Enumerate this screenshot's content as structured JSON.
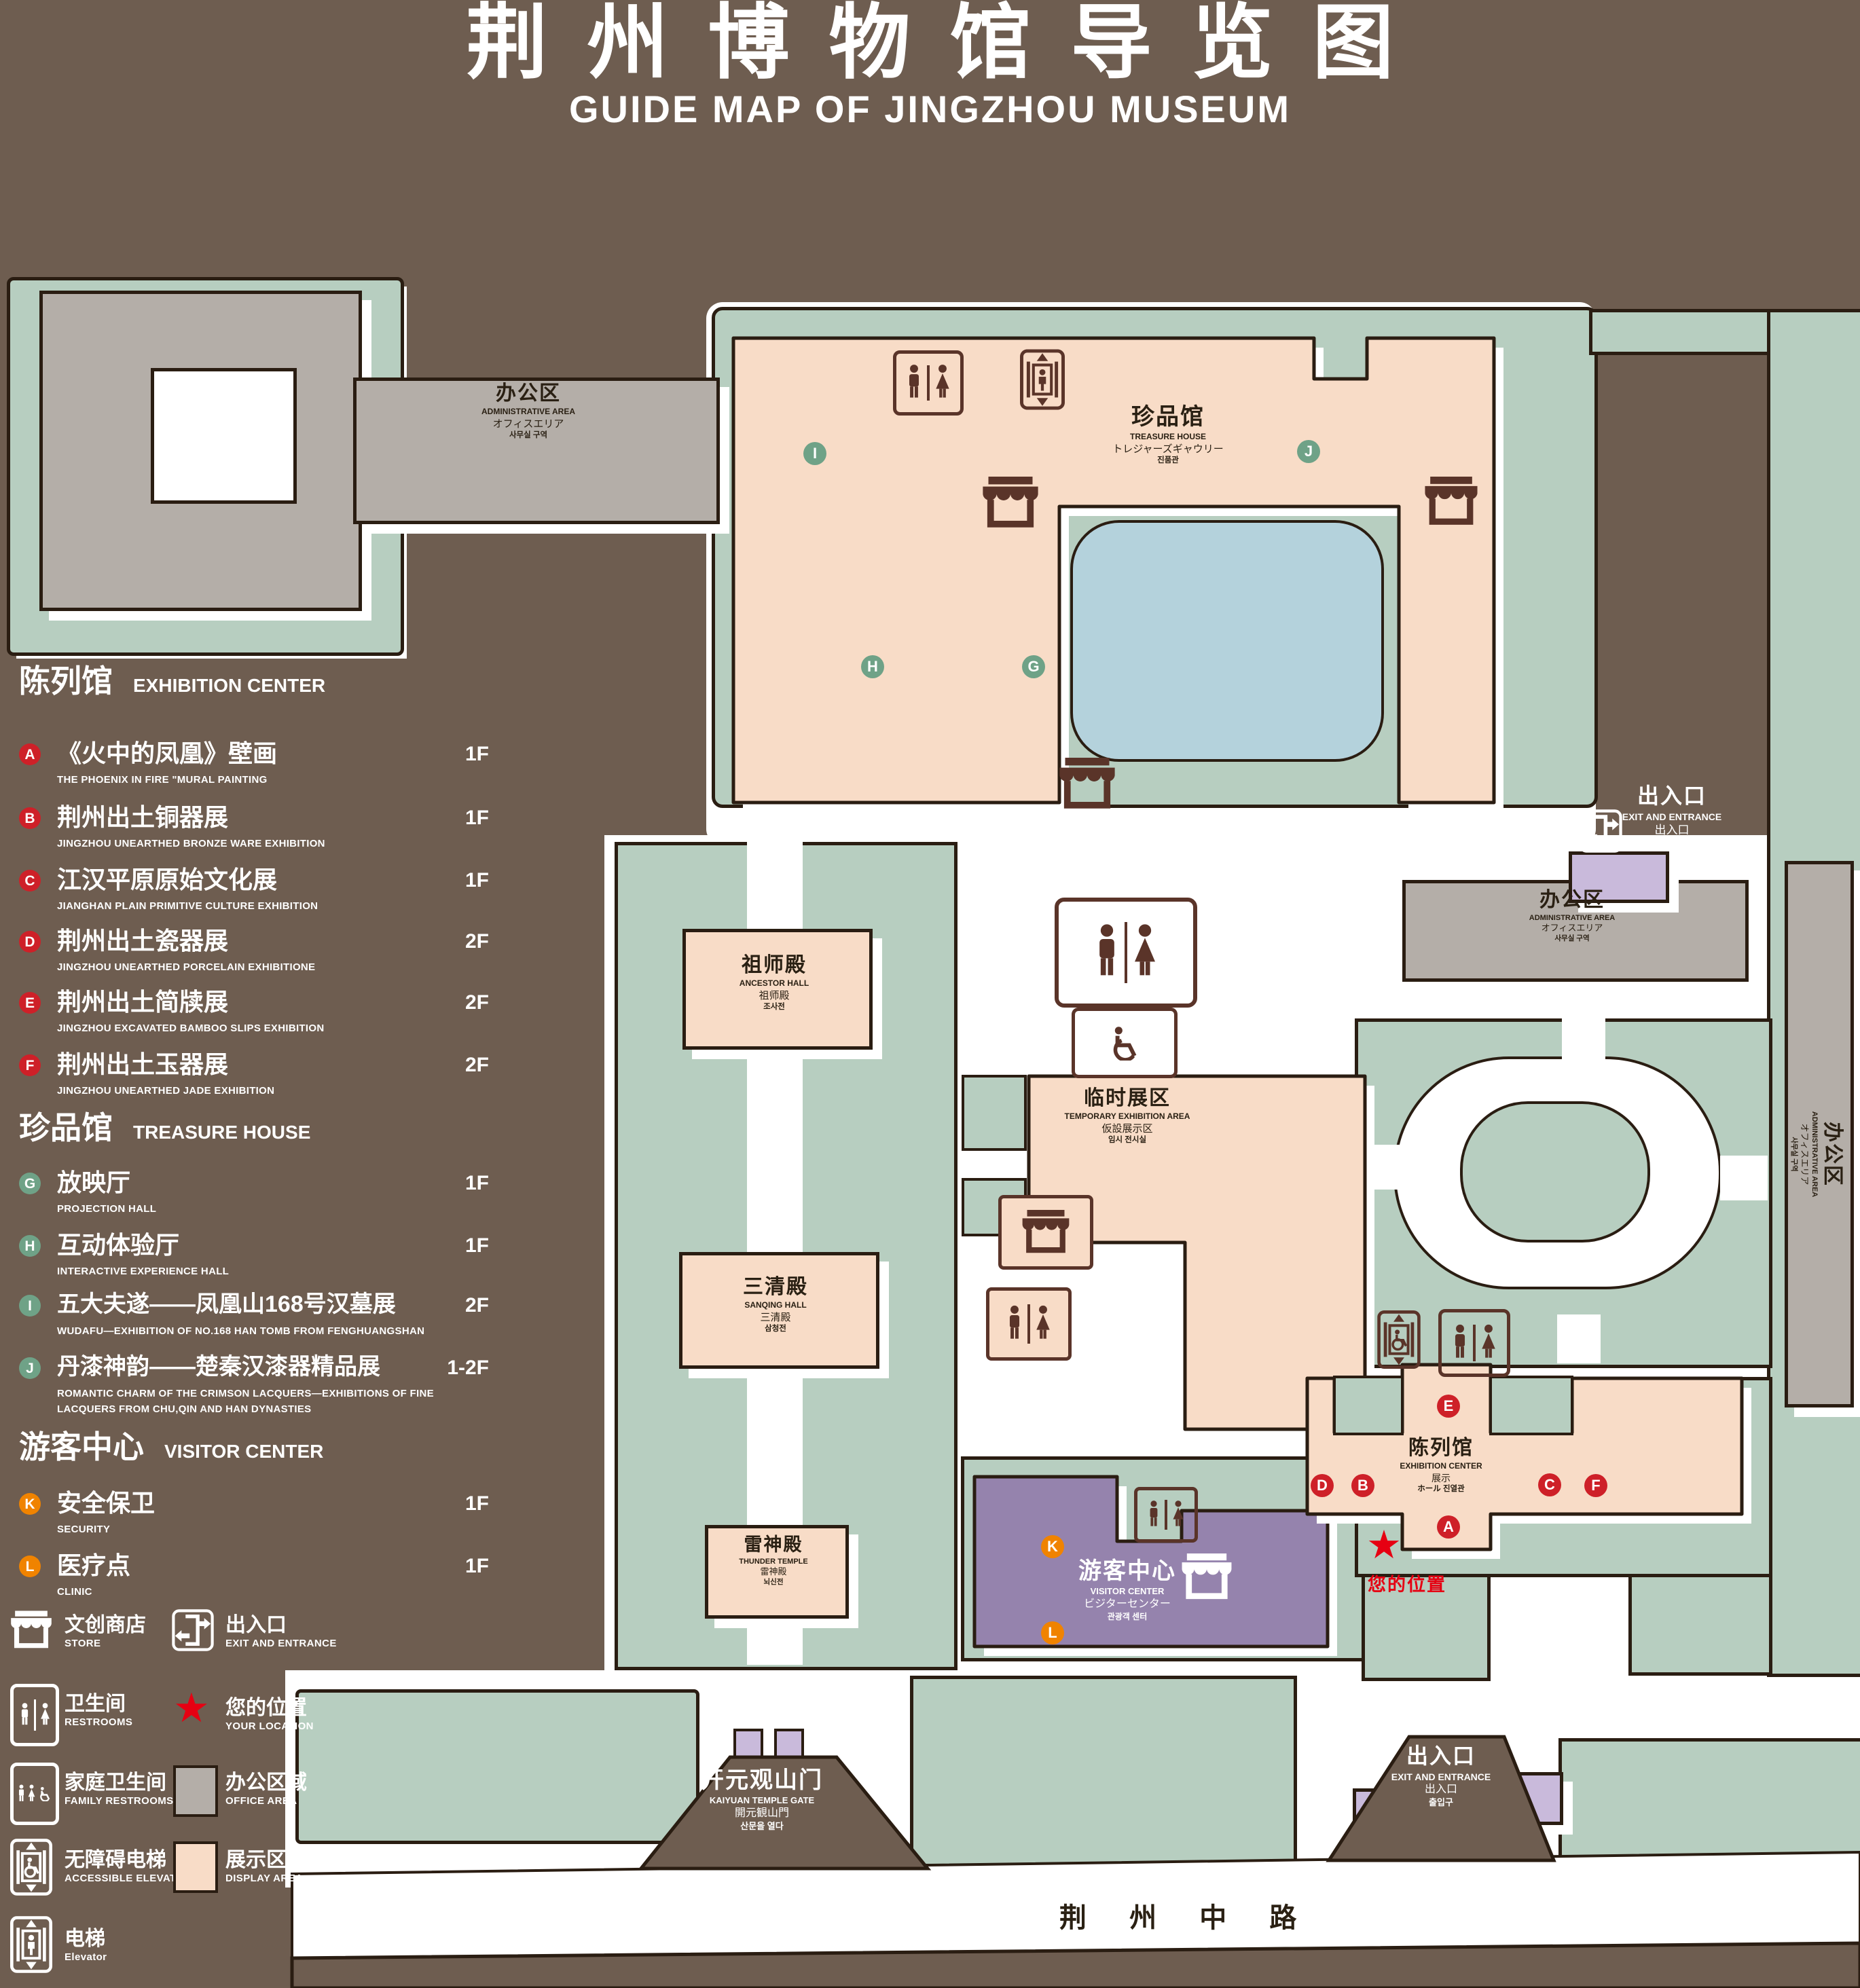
{
  "title": {
    "zh": "荆州博物馆导览图",
    "en": "GUIDE MAP OF JINGZHOU MUSEUM"
  },
  "colors": {
    "background": "#6e5d50",
    "lawn": "#b7cec0",
    "display_area": "#f8dcc7",
    "office_area": "#b4aea8",
    "pond": "#b4d2dc",
    "visitor_center": "#9583ad",
    "small_building": "#c9badb",
    "outline": "#2a1d12",
    "badge_red": "#ce2028",
    "badge_green": "#6fa287",
    "badge_orange": "#f08300",
    "location_red": "#e60012",
    "icon_brown": "#5a3429",
    "path_white": "#ffffff"
  },
  "sidebar": {
    "sections": [
      {
        "id": "exhibition_center",
        "title_zh": "陈列馆",
        "title_en": "EXHIBITION CENTER",
        "items": [
          {
            "letter": "A",
            "zh": "《火中的凤凰》壁画",
            "en": "THE PHOENIX IN FIRE \"MURAL PAINTING",
            "floor": "1F"
          },
          {
            "letter": "B",
            "zh": "荆州出土铜器展",
            "en": "JINGZHOU UNEARTHED BRONZE WARE EXHIBITION",
            "floor": "1F"
          },
          {
            "letter": "C",
            "zh": "江汉平原原始文化展",
            "en": "JIANGHAN PLAIN PRIMITIVE CULTURE EXHIBITION",
            "floor": "1F"
          },
          {
            "letter": "D",
            "zh": "荆州出土瓷器展",
            "en": "JINGZHOU UNEARTHED PORCELAIN EXHIBITIONE",
            "floor": "2F"
          },
          {
            "letter": "E",
            "zh": "荆州出土简牍展",
            "en": "JINGZHOU EXCAVATED BAMBOO SLIPS EXHIBITION",
            "floor": "2F"
          },
          {
            "letter": "F",
            "zh": "荆州出土玉器展",
            "en": "JINGZHOU UNEARTHED JADE EXHIBITION",
            "floor": "2F"
          }
        ]
      },
      {
        "id": "treasure_house",
        "title_zh": "珍品馆",
        "title_en": "TREASURE HOUSE",
        "items": [
          {
            "letter": "G",
            "zh": "放映厅",
            "en": "PROJECTION HALL",
            "floor": "1F"
          },
          {
            "letter": "H",
            "zh": "互动体验厅",
            "en": "INTERACTIVE EXPERIENCE HALL",
            "floor": "1F"
          },
          {
            "letter": "I",
            "zh": "五大夫遂——凤凰山168号汉墓展",
            "en": "WUDAFU—EXHIBITION OF NO.168 HAN TOMB FROM FENGHUANGSHAN",
            "floor": "2F"
          },
          {
            "letter": "J",
            "zh": "丹漆神韵——楚秦汉漆器精品展",
            "en": "ROMANTIC CHARM OF THE CRIMSON LACQUERS—EXHIBITIONS OF FINE LACQUERS FROM CHU,QIN AND HAN DYNASTIES",
            "floor": "1-2F"
          }
        ]
      },
      {
        "id": "visitor_center",
        "title_zh": "游客中心",
        "title_en": "VISITOR CENTER",
        "items": [
          {
            "letter": "K",
            "zh": "安全保卫",
            "en": "SECURITY",
            "floor": "1F"
          },
          {
            "letter": "L",
            "zh": "医疗点",
            "en": "CLINIC",
            "floor": "1F"
          }
        ]
      }
    ],
    "facilities": [
      {
        "icon": "store-icon",
        "zh": "文创商店",
        "en": "STORE"
      },
      {
        "icon": "exit-icon",
        "zh": "出入口",
        "en": "EXIT AND ENTRANCE"
      },
      {
        "icon": "restrooms-icon",
        "zh": "卫生间",
        "en": "RESTROOMS"
      },
      {
        "icon": "your-location-star",
        "zh": "您的位置",
        "en": "YOUR LOCATION"
      },
      {
        "icon": "family-restrooms-icon",
        "zh": "家庭卫生间",
        "en": "FAMILY RESTROOMS"
      },
      {
        "icon": "office-area-swatch",
        "zh": "办公区域",
        "en": "OFFICE AREA"
      },
      {
        "icon": "accessible-elevator-icon",
        "zh": "无障碍电梯",
        "en": "ACCESSIBLE ELEVATOR"
      },
      {
        "icon": "display-area-swatch",
        "zh": "展示区域",
        "en": "DISPLAY AREA"
      },
      {
        "icon": "elevator-icon",
        "zh": "电梯",
        "en": "Elevator"
      }
    ]
  },
  "map": {
    "buildings": {
      "admin": {
        "zh": "办公区",
        "en": "ADMINISTRATIVE AREA",
        "ja": "オフィスエリア",
        "ko": "사무실 구역"
      },
      "treasure_house": {
        "zh": "珍品馆",
        "en": "TREASURE HOUSE",
        "ja": "トレジャーズギャウリー",
        "ko": "진품관"
      },
      "ancestor_hall": {
        "zh": "祖师殿",
        "en": "ANCESTOR HALL",
        "ja": "祖师殿",
        "ko": "조사전"
      },
      "sanqing_hall": {
        "zh": "三清殿",
        "en": "SANQING HALL",
        "ja": "三清殿",
        "ko": "삼청전"
      },
      "thunder_temple": {
        "zh": "雷神殿",
        "en": "THUNDER TEMPLE",
        "ja": "雷神殿",
        "ko": "뇌신전"
      },
      "temporary": {
        "zh": "临时展区",
        "en": "TEMPORARY EXHIBITION AREA",
        "ja": "仮設展示区",
        "ko": "임시 전시실"
      },
      "visitor_center": {
        "zh": "游客中心",
        "en": "VISITOR CENTER",
        "ja": "ビジターセンター",
        "ko": "관광객 센터"
      },
      "exhibition_center": {
        "zh": "陈列馆",
        "en": "EXHIBITION CENTER",
        "ja": "展示",
        "ko": "ホール 진열관"
      },
      "gate": {
        "zh": "开元观山门",
        "en": "KAIYUAN TEMPLE GATE",
        "ja": "開元観山門",
        "ko": "산문을 열다"
      },
      "entrance": {
        "zh": "出入口",
        "en": "EXIT AND ENTRANCE",
        "ja": "出入口",
        "ko": "출입구"
      }
    },
    "your_location": {
      "zh": "您的位置"
    },
    "road": {
      "zh": "荆 州 中 路"
    }
  }
}
